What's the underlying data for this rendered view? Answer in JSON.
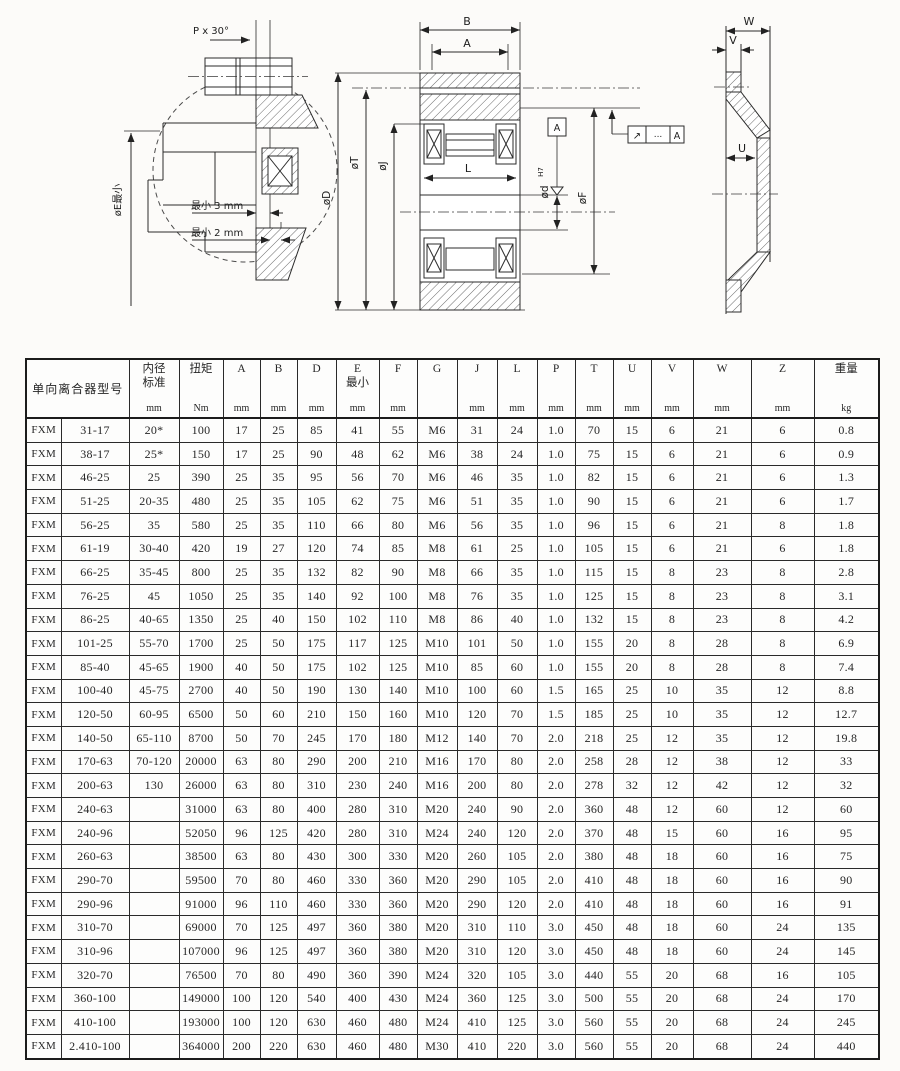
{
  "page": {
    "paper_color": "#fcfbf9",
    "ink_color": "#1c1c1c"
  },
  "drawings": {
    "detail": {
      "p_label": "P x 30°",
      "e_label": "øE最小",
      "min3": "最小 3 mm",
      "min2": "最小 2 mm"
    },
    "section": {
      "b": "B",
      "a": "A",
      "l": "L",
      "d": "øD",
      "t": "øT",
      "j": "øJ",
      "d_bore": "ød",
      "d_bore_tol": "H7",
      "f": "øF",
      "datum": "A",
      "fcf_symbol": "↗",
      "fcf_value": "...",
      "fcf_datum": "A"
    },
    "profile": {
      "w": "W",
      "v": "V",
      "u": "U"
    }
  },
  "table": {
    "header": {
      "model": "单向离合器型号",
      "cols": [
        {
          "label": "内径\n标准",
          "unit": "mm"
        },
        {
          "label": "扭矩",
          "unit": "Nm"
        },
        {
          "label": "A",
          "unit": "mm"
        },
        {
          "label": "B",
          "unit": "mm"
        },
        {
          "label": "D",
          "unit": "mm"
        },
        {
          "label": "E\n最小",
          "unit": "mm"
        },
        {
          "label": "F",
          "unit": "mm"
        },
        {
          "label": "G",
          "unit": ""
        },
        {
          "label": "J",
          "unit": "mm"
        },
        {
          "label": "L",
          "unit": "mm"
        },
        {
          "label": "P",
          "unit": "mm"
        },
        {
          "label": "T",
          "unit": "mm"
        },
        {
          "label": "U",
          "unit": "mm"
        },
        {
          "label": "V",
          "unit": "mm"
        },
        {
          "label": "W",
          "unit": "mm"
        },
        {
          "label": "Z",
          "unit": "mm"
        },
        {
          "label": "重量",
          "unit": "kg"
        }
      ]
    },
    "rows": [
      [
        "FXM",
        "31-17",
        "20*",
        "100",
        "17",
        "25",
        "85",
        "41",
        "55",
        "M6",
        "31",
        "24",
        "1.0",
        "70",
        "15",
        "6",
        "21",
        "6",
        "0.8"
      ],
      [
        "FXM",
        "38-17",
        "25*",
        "150",
        "17",
        "25",
        "90",
        "48",
        "62",
        "M6",
        "38",
        "24",
        "1.0",
        "75",
        "15",
        "6",
        "21",
        "6",
        "0.9"
      ],
      [
        "FXM",
        "46-25",
        "25",
        "390",
        "25",
        "35",
        "95",
        "56",
        "70",
        "M6",
        "46",
        "35",
        "1.0",
        "82",
        "15",
        "6",
        "21",
        "6",
        "1.3"
      ],
      [
        "FXM",
        "51-25",
        "20-35",
        "480",
        "25",
        "35",
        "105",
        "62",
        "75",
        "M6",
        "51",
        "35",
        "1.0",
        "90",
        "15",
        "6",
        "21",
        "6",
        "1.7"
      ],
      [
        "FXM",
        "56-25",
        "35",
        "580",
        "25",
        "35",
        "110",
        "66",
        "80",
        "M6",
        "56",
        "35",
        "1.0",
        "96",
        "15",
        "6",
        "21",
        "8",
        "1.8"
      ],
      [
        "FXM",
        "61-19",
        "30-40",
        "420",
        "19",
        "27",
        "120",
        "74",
        "85",
        "M8",
        "61",
        "25",
        "1.0",
        "105",
        "15",
        "6",
        "21",
        "6",
        "1.8"
      ],
      [
        "FXM",
        "66-25",
        "35-45",
        "800",
        "25",
        "35",
        "132",
        "82",
        "90",
        "M8",
        "66",
        "35",
        "1.0",
        "115",
        "15",
        "8",
        "23",
        "8",
        "2.8"
      ],
      [
        "FXM",
        "76-25",
        "45",
        "1050",
        "25",
        "35",
        "140",
        "92",
        "100",
        "M8",
        "76",
        "35",
        "1.0",
        "125",
        "15",
        "8",
        "23",
        "8",
        "3.1"
      ],
      [
        "FXM",
        "86-25",
        "40-65",
        "1350",
        "25",
        "40",
        "150",
        "102",
        "110",
        "M8",
        "86",
        "40",
        "1.0",
        "132",
        "15",
        "8",
        "23",
        "8",
        "4.2"
      ],
      [
        "FXM",
        "101-25",
        "55-70",
        "1700",
        "25",
        "50",
        "175",
        "117",
        "125",
        "M10",
        "101",
        "50",
        "1.0",
        "155",
        "20",
        "8",
        "28",
        "8",
        "6.9"
      ],
      [
        "FXM",
        "85-40",
        "45-65",
        "1900",
        "40",
        "50",
        "175",
        "102",
        "125",
        "M10",
        "85",
        "60",
        "1.0",
        "155",
        "20",
        "8",
        "28",
        "8",
        "7.4"
      ],
      [
        "FXM",
        "100-40",
        "45-75",
        "2700",
        "40",
        "50",
        "190",
        "130",
        "140",
        "M10",
        "100",
        "60",
        "1.5",
        "165",
        "25",
        "10",
        "35",
        "12",
        "8.8"
      ],
      [
        "FXM",
        "120-50",
        "60-95",
        "6500",
        "50",
        "60",
        "210",
        "150",
        "160",
        "M10",
        "120",
        "70",
        "1.5",
        "185",
        "25",
        "10",
        "35",
        "12",
        "12.7"
      ],
      [
        "FXM",
        "140-50",
        "65-110",
        "8700",
        "50",
        "70",
        "245",
        "170",
        "180",
        "M12",
        "140",
        "70",
        "2.0",
        "218",
        "25",
        "12",
        "35",
        "12",
        "19.8"
      ],
      [
        "FXM",
        "170-63",
        "70-120",
        "20000",
        "63",
        "80",
        "290",
        "200",
        "210",
        "M16",
        "170",
        "80",
        "2.0",
        "258",
        "28",
        "12",
        "38",
        "12",
        "33"
      ],
      [
        "FXM",
        "200-63",
        "130",
        "26000",
        "63",
        "80",
        "310",
        "230",
        "240",
        "M16",
        "200",
        "80",
        "2.0",
        "278",
        "32",
        "12",
        "42",
        "12",
        "32"
      ],
      [
        "FXM",
        "240-63",
        "",
        "31000",
        "63",
        "80",
        "400",
        "280",
        "310",
        "M20",
        "240",
        "90",
        "2.0",
        "360",
        "48",
        "12",
        "60",
        "12",
        "60"
      ],
      [
        "FXM",
        "240-96",
        "",
        "52050",
        "96",
        "125",
        "420",
        "280",
        "310",
        "M24",
        "240",
        "120",
        "2.0",
        "370",
        "48",
        "15",
        "60",
        "16",
        "95"
      ],
      [
        "FXM",
        "260-63",
        "",
        "38500",
        "63",
        "80",
        "430",
        "300",
        "330",
        "M20",
        "260",
        "105",
        "2.0",
        "380",
        "48",
        "18",
        "60",
        "16",
        "75"
      ],
      [
        "FXM",
        "290-70",
        "",
        "59500",
        "70",
        "80",
        "460",
        "330",
        "360",
        "M20",
        "290",
        "105",
        "2.0",
        "410",
        "48",
        "18",
        "60",
        "16",
        "90"
      ],
      [
        "FXM",
        "290-96",
        "",
        "91000",
        "96",
        "110",
        "460",
        "330",
        "360",
        "M20",
        "290",
        "120",
        "2.0",
        "410",
        "48",
        "18",
        "60",
        "16",
        "91"
      ],
      [
        "FXM",
        "310-70",
        "",
        "69000",
        "70",
        "125",
        "497",
        "360",
        "380",
        "M20",
        "310",
        "110",
        "3.0",
        "450",
        "48",
        "18",
        "60",
        "24",
        "135"
      ],
      [
        "FXM",
        "310-96",
        "",
        "107000",
        "96",
        "125",
        "497",
        "360",
        "380",
        "M20",
        "310",
        "120",
        "3.0",
        "450",
        "48",
        "18",
        "60",
        "24",
        "145"
      ],
      [
        "FXM",
        "320-70",
        "",
        "76500",
        "70",
        "80",
        "490",
        "360",
        "390",
        "M24",
        "320",
        "105",
        "3.0",
        "440",
        "55",
        "20",
        "68",
        "16",
        "105"
      ],
      [
        "FXM",
        "360-100",
        "",
        "149000",
        "100",
        "120",
        "540",
        "400",
        "430",
        "M24",
        "360",
        "125",
        "3.0",
        "500",
        "55",
        "20",
        "68",
        "24",
        "170"
      ],
      [
        "FXM",
        "410-100",
        "",
        "193000",
        "100",
        "120",
        "630",
        "460",
        "480",
        "M24",
        "410",
        "125",
        "3.0",
        "560",
        "55",
        "20",
        "68",
        "24",
        "245"
      ],
      [
        "FXM",
        "2.410-100",
        "",
        "364000",
        "200",
        "220",
        "630",
        "460",
        "480",
        "M30",
        "410",
        "220",
        "3.0",
        "560",
        "55",
        "20",
        "68",
        "24",
        "440"
      ]
    ]
  }
}
